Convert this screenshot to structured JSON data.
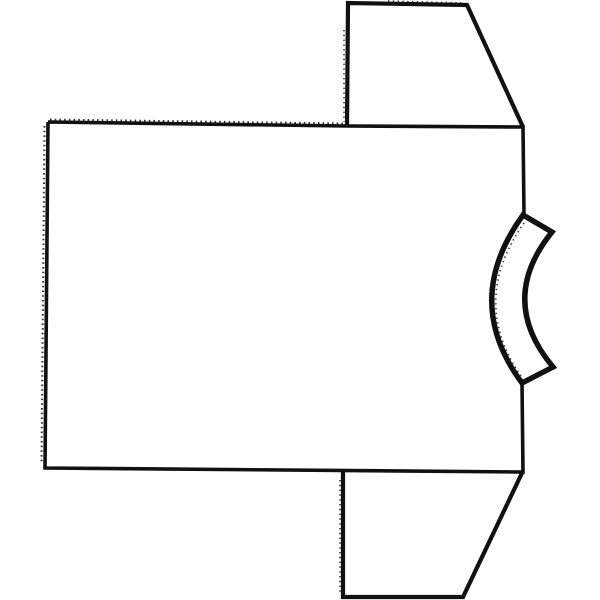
{
  "figure": {
    "title": "T-shirt pattern line drawing",
    "description": "Black ink outline drawing of a short-sleeved T-shirt lying on its side: large rectangular body panel on the left, two trapezoid sleeves pointing up and down on the right, and a curved collar neckband bulging from the right edge. Stitch tick marks run along the top and left body edges, sleeve edges and neckband.",
    "background_color": "#ffffff",
    "ink_color": "#111111",
    "parts": [
      {
        "name": "body",
        "label": "shirt body panel"
      },
      {
        "name": "top-sleeve",
        "label": "upper sleeve"
      },
      {
        "name": "bottom-sleeve",
        "label": "lower sleeve"
      },
      {
        "name": "neckband",
        "label": "collar neckband"
      }
    ],
    "paths": {
      "body_outline": "M48,122 L347,126 L523,127 L524,215 M522,383 L523,472 L45,468 L48,122",
      "top_sleeve": "M347,126 L348,3 L467,5 L523,127",
      "bottom_sleeve": "M343,472 L343,597 L463,597 L522,473",
      "neckband": "M523,215 Q461,301 522,383 L553,367 Q497,300 552,232 Z",
      "stitch_body_top": "M50,119.5 L345,123.5",
      "stitch_body_left": "M44.5,126 L41.5,464",
      "stitch_sleeve_top": "M388,1 L462,3",
      "stitch_top_sleeve_left": "M344,30 L344,122",
      "stitch_bottom_sleeve_left": "M340,480 L340,594",
      "stitch_neck_inner": "M524,223 Q469,301 521,376",
      "stitch_neck_outer": "M547,238 Q503,300 548,361"
    }
  }
}
